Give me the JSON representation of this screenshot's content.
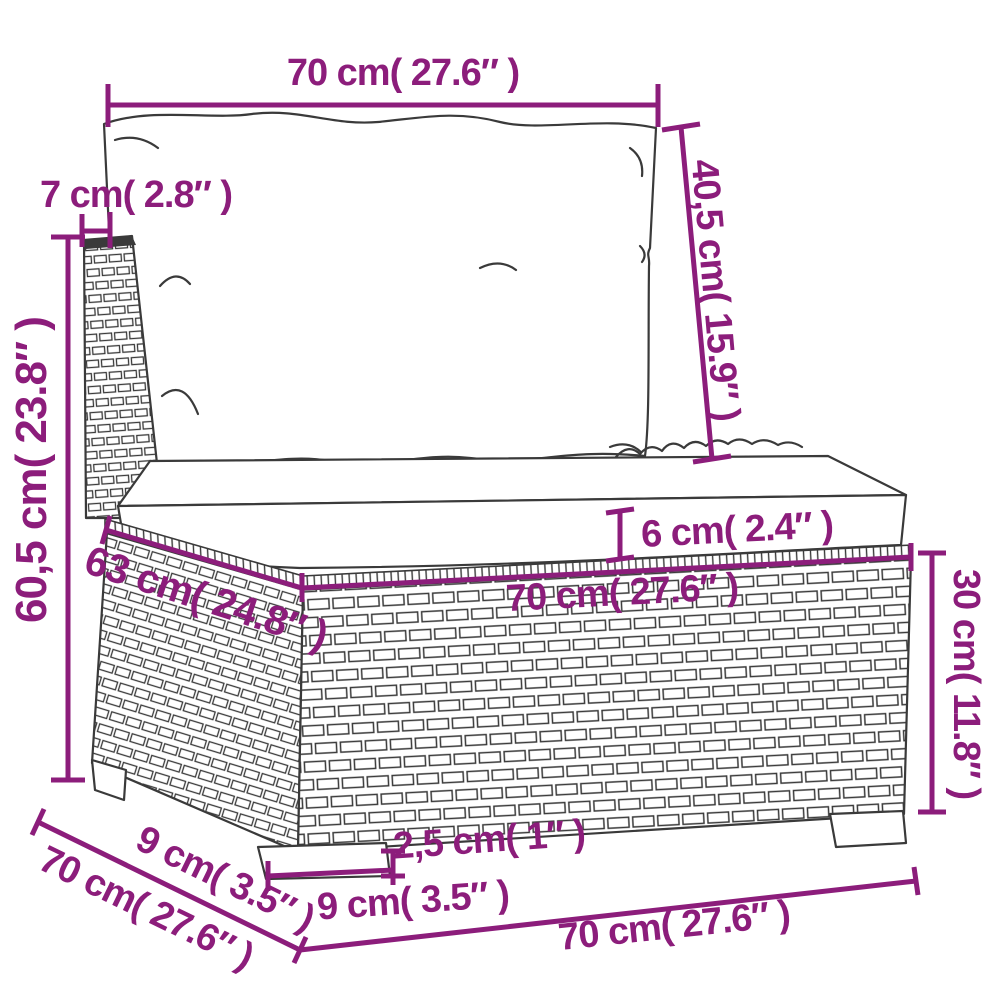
{
  "colors": {
    "dimension_accent": "#8C1D7B",
    "line_art": "#3A3A3A",
    "background": "#FFFFFF"
  },
  "dims": {
    "top_width": "70 cm( 27.6″ )",
    "back_post_width": "7 cm( 2.8″ )",
    "back_cushion_height": "40,5 cm( 15.9″ )",
    "overall_height": "60,5 cm( 23.8″ )",
    "seat_cushion_thickness": "6 cm( 2.4″ )",
    "seat_depth_inner": "63 cm( 24.8″ )",
    "seat_width": "70 cm( 27.6″ )",
    "base_height": "30 cm( 11.8″ )",
    "leg_height": "2,5 cm( 1″ )",
    "leg_width": "9 cm( 3.5″ )",
    "side_leg_inset": "9 cm( 3.5″ )",
    "side_depth": "70 cm( 27.6″ )",
    "front_width_bottom": "70 cm( 27.6″ )"
  },
  "furniture_parts": [
    "back-cushion",
    "seat-cushion",
    "rattan-back-post",
    "rattan-base-side",
    "rattan-base-front",
    "front-left-leg",
    "front-right-leg",
    "back-left-leg"
  ]
}
